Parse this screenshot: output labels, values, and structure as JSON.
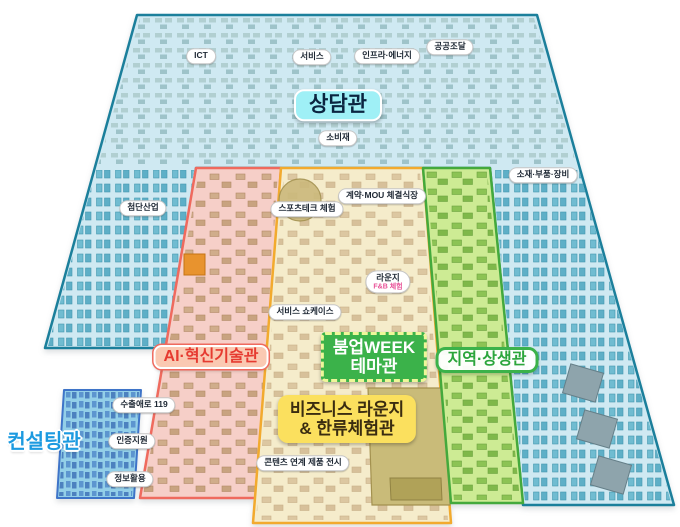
{
  "map": {
    "title": "전시장 배치도",
    "halls": {
      "sangdam": "상담관",
      "ai": "AI·혁신기술관",
      "boomup_line1": "붐업WEEK",
      "boomup_line2": "테마관",
      "jiyeok": "지역·상생관",
      "consulting": "컨설팅관",
      "biz_line1": "비즈니스 라운지",
      "biz_line2": "& 한류체험관"
    },
    "pills": {
      "ict": "ICT",
      "service": "서비스",
      "infra": "인프라·에너지",
      "procurement": "공공조달",
      "consumer": "소비재",
      "advanced": "첨단산업",
      "materials": "소재·부품·장비",
      "sportstech": "스포츠테크 체험",
      "mou": "계약·MOU 체결식장",
      "lounge": "라운지",
      "lounge_sub": "F&B 체험",
      "showcase": "서비스 쇼케이스",
      "export119": "수출애로 119",
      "cert": "인증지원",
      "info": "정보활용",
      "contents": "콘텐츠 연계 제품 전시"
    },
    "colors": {
      "hall_blue_fill": "#cfe9f2",
      "hall_blue_border": "#1b7f9b",
      "zone_pink_fill": "#f6cfc8",
      "zone_pink_border": "#ef6a5e",
      "zone_yellow_fill": "#f5eccb",
      "zone_yellow_border": "#f2aa2e",
      "zone_green_fill": "#cdeb94",
      "zone_green_border": "#44a93c",
      "zone_consult_fill": "#93cfe8",
      "zone_consult_border": "#3e74c8",
      "sangdam_bg": "#9ff0f6",
      "ai_bg": "#fac9b2",
      "ai_text": "#e63a30",
      "boomup_bg": "#3bb24a",
      "jiyeok_text": "#2ba53c",
      "biz_bg": "#fbe05e",
      "consulting_text": "#1c9ae0",
      "lounge_sub_text": "#e85298"
    }
  }
}
